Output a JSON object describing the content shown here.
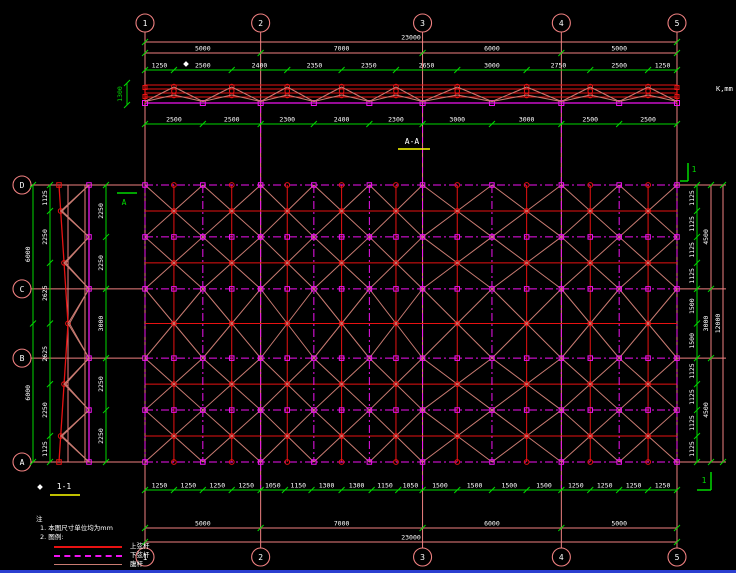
{
  "colors": {
    "background": "#000000",
    "grid_pink": "#ef8080",
    "red": "#e81212",
    "magenta": "#f012f0",
    "web": "#c97b72",
    "green": "#00d800",
    "text": "#ffffff",
    "yellow": "#ffff00",
    "blue_bar": "#2b3fd0"
  },
  "labels": {
    "section_aa": "A-A",
    "section_11": "1-1",
    "unit": "K,mm",
    "marker_a": "A",
    "marker_1": "1",
    "elev_height": "1300"
  },
  "grid": {
    "columns": [
      "1",
      "2",
      "3",
      "4",
      "5"
    ],
    "rows": [
      "D",
      "C",
      "B",
      "A"
    ],
    "row_mm": [
      0,
      4500,
      7500,
      12000
    ]
  },
  "elevation": {
    "total": "23000",
    "spans": [
      "5000",
      "7000",
      "6000",
      "5000"
    ],
    "top_dims": [
      "1250",
      "2500",
      "2400",
      "2350",
      "2350",
      "2650",
      "3000",
      "2750",
      "2500",
      "1250"
    ],
    "bottom_dims": [
      "2500",
      "2500",
      "2300",
      "2400",
      "2300",
      "3000",
      "3000",
      "2500",
      "2500"
    ]
  },
  "plan": {
    "left_dims": [
      "2250",
      "2250",
      "3000",
      "2250",
      "2250"
    ],
    "right_inner_dims": [
      "1125",
      "1125",
      "1125",
      "1125",
      "1500",
      "1500",
      "1125",
      "1125",
      "1125",
      "1125"
    ],
    "right_mid_dims": [
      "4500",
      "3000",
      "4500"
    ],
    "right_outer_dims": [
      "12000"
    ]
  },
  "section": {
    "inner_dims": [
      "1125",
      "2250",
      "2625",
      "2625",
      "2250",
      "1125"
    ],
    "outer_dims": [
      "6000",
      "6000"
    ]
  },
  "bottom": {
    "small_dims": [
      "1250",
      "1250",
      "1250",
      "1250",
      "1050",
      "1150",
      "1300",
      "1300",
      "1150",
      "1050",
      "1500",
      "1500",
      "1500",
      "1500",
      "1250",
      "1250",
      "1250",
      "1250"
    ],
    "spans": [
      "5000",
      "7000",
      "6000",
      "5000"
    ],
    "total": "23000"
  },
  "legend": {
    "title": "注",
    "note1": "1. 本图尺寸单位均为mm",
    "note2": "2. 图例:",
    "items": [
      {
        "label": "上弦杆"
      },
      {
        "label": "下弦杆"
      },
      {
        "label": "腹杆"
      }
    ]
  }
}
